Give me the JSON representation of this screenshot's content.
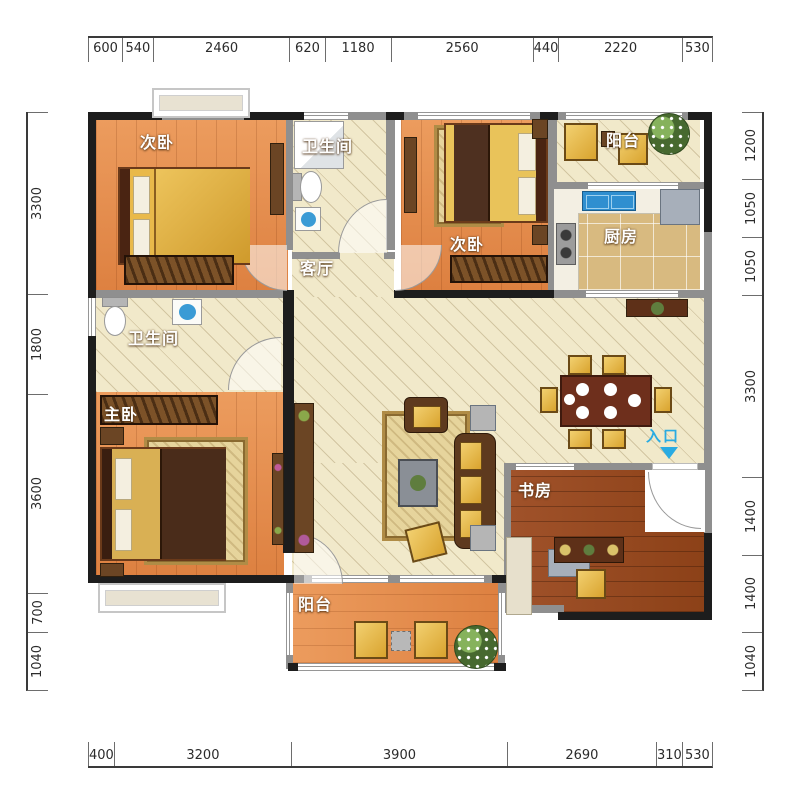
{
  "page": {
    "type": "apartment-floor-plan",
    "background": "#ffffff"
  },
  "rooms": [
    {
      "id": "bedroom-top-left",
      "label": "次卧"
    },
    {
      "id": "bathroom-top",
      "label": "卫生间"
    },
    {
      "id": "living-room",
      "label": "客厅"
    },
    {
      "id": "bedroom-top-right",
      "label": "次卧"
    },
    {
      "id": "balcony-top",
      "label": "阳台"
    },
    {
      "id": "kitchen",
      "label": "厨房"
    },
    {
      "id": "bathroom-left",
      "label": "卫生间"
    },
    {
      "id": "master-bedroom",
      "label": "主卧"
    },
    {
      "id": "study",
      "label": "书房"
    },
    {
      "id": "balcony-bottom",
      "label": "阳台"
    }
  ],
  "entrance": {
    "label": "入口",
    "color": "#29ABE2"
  },
  "dimensions_mm": {
    "top": [
      600,
      540,
      2460,
      620,
      1180,
      2560,
      440,
      2220,
      530
    ],
    "bottom": [
      400,
      3200,
      3900,
      2690,
      310,
      530
    ],
    "left": [
      3300,
      1800,
      3600,
      700,
      1040
    ],
    "right": [
      1200,
      1050,
      1050,
      3300,
      1400,
      1400,
      1040
    ]
  },
  "colors": {
    "outer_wall": "#1d1d1d",
    "inner_wall": "#8f8f8f",
    "tile_floor": "#f1e9ca",
    "wood_floor": "#e28c50",
    "study_floor": "#9a4a1e",
    "kitchen_floor": "#d8ba80",
    "entrance_accent": "#29ABE2",
    "dimension_text": "#2b2b2b"
  }
}
